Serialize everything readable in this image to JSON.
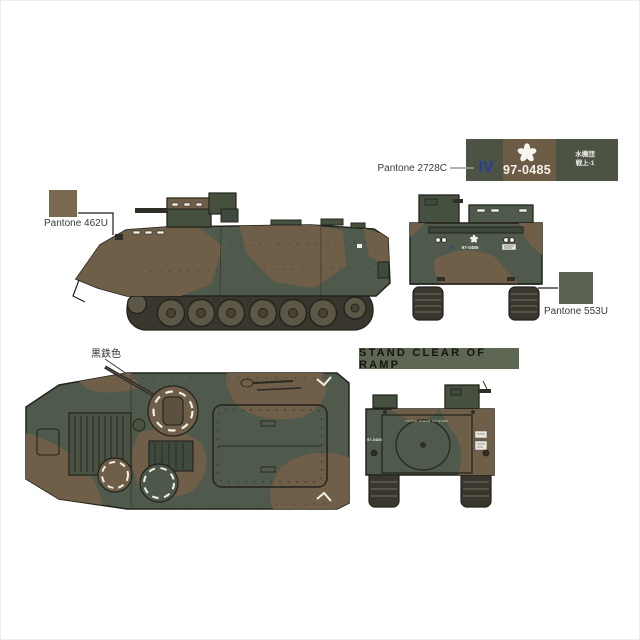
{
  "colors": {
    "camo_green": "#4f5a4d",
    "camo_green_dark": "#45503f",
    "camo_brown": "#6f5e48",
    "track_dark": "#38362d",
    "wheel": "#5d5748",
    "outline": "#23231c",
    "pantone_462u": "#7a6850",
    "pantone_553u": "#5b6254",
    "decal_green": "#4c5345",
    "decal_brown": "#6d5c45",
    "roman_blue": "#24409a",
    "banner_green": "#5d6754",
    "leader_gray": "#9a9a9a",
    "leader_black": "#1c1c1c"
  },
  "callouts": {
    "pantone_462u": "Pantone 462U",
    "pantone_2728c": "Pantone 2728C",
    "pantone_553u": "Pantone 553U",
    "barrel_color": "黒鉄色"
  },
  "decal": {
    "roman_numeral": "IV",
    "registration": "97-0485",
    "unit_line1": "水機団",
    "unit_line2": "戦上-1"
  },
  "ramp_banner": {
    "text": "STAND CLEAR OF RAMP"
  },
  "vehicle_markings": {
    "front_roman": "IV",
    "front_registration": "97-0485",
    "rear_registration": "97-0485",
    "rear_ramp_warning": "STAND CLEAR OF RAMP"
  }
}
